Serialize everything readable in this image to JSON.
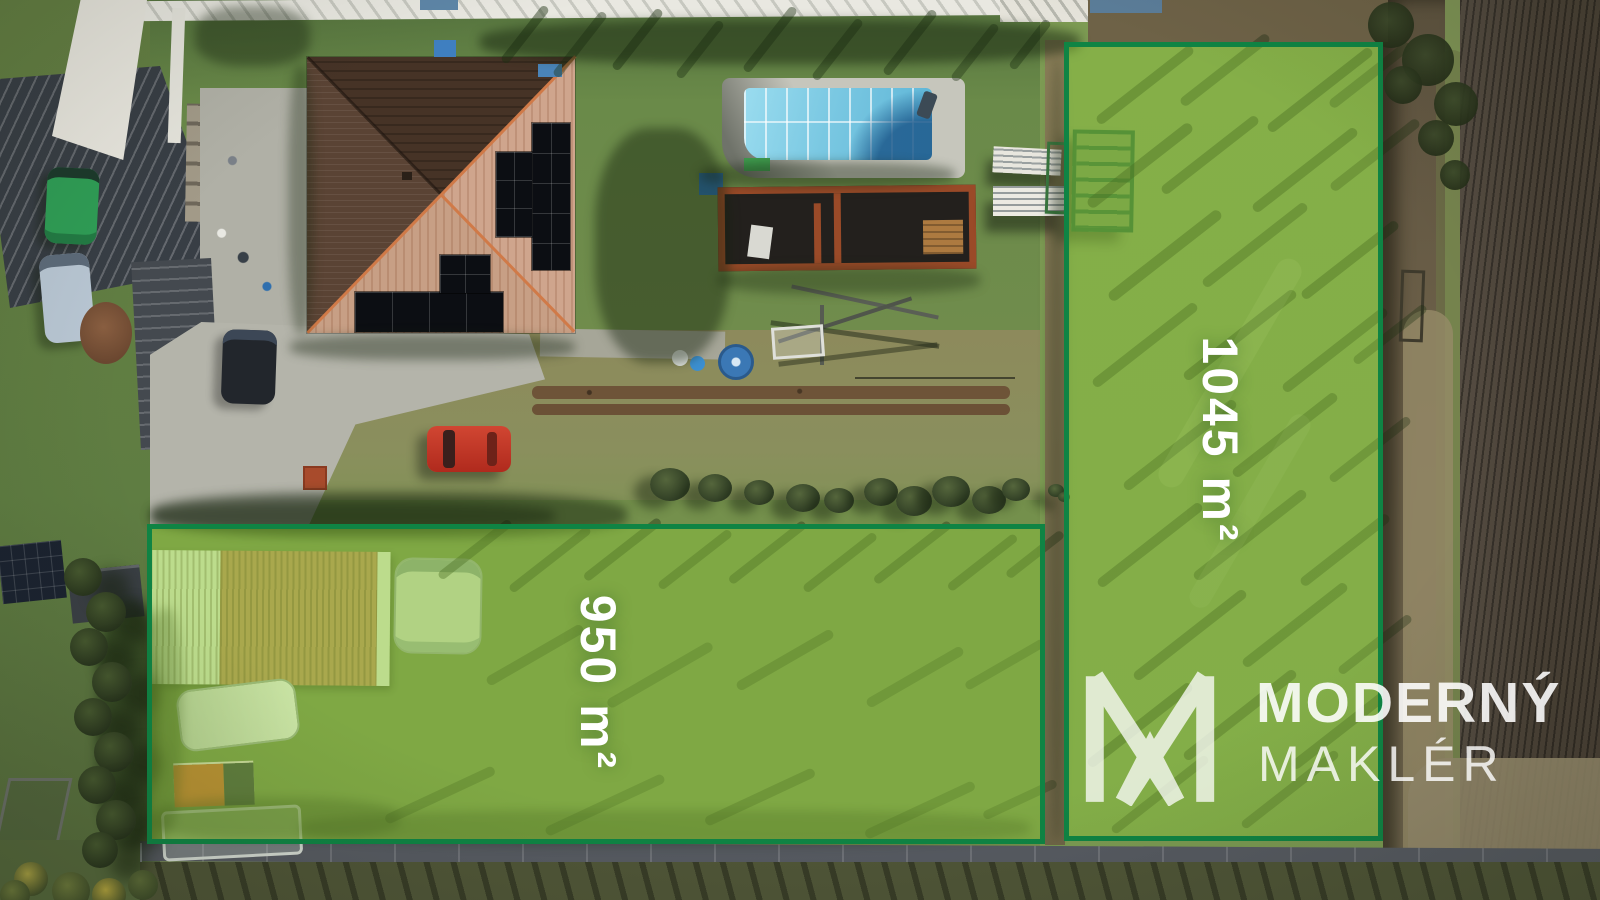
{
  "plots": [
    {
      "name": "right-plot",
      "area_label": "1045 m²"
    },
    {
      "name": "left-plot",
      "area_label": "950 m²"
    }
  ],
  "watermark": {
    "icon": "m-monogram-icon",
    "line1": "MODERNÝ",
    "line2": "MAKLÉR"
  },
  "colors": {
    "plot_border": "#0f8444",
    "plot_fill": "rgba(146,205,58,0.40)",
    "label_text": "#ffffff",
    "watermark_text": "rgba(255,255,255,0.88)"
  }
}
